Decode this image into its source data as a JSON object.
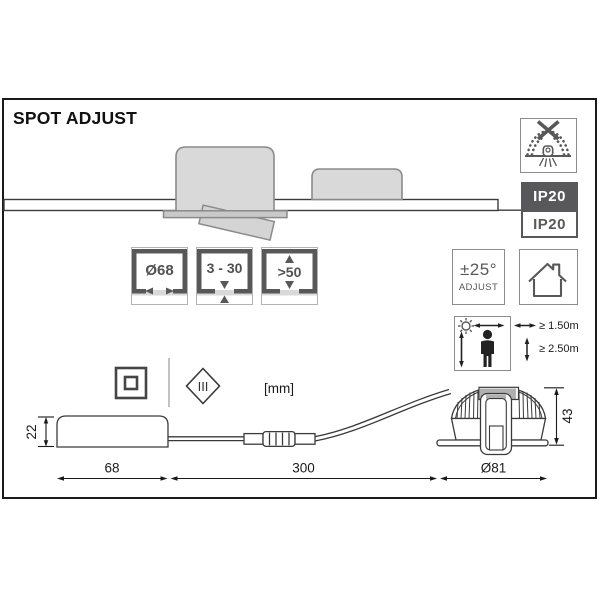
{
  "header": {
    "title": "SPOT ADJUST"
  },
  "ceiling_icons": {
    "cutout_label": "Ø68",
    "thickness_label": "3 - 30",
    "clearance_label": ">50"
  },
  "ratings": {
    "ip_primary": "IP20",
    "ip_secondary": "IP20"
  },
  "adjust": {
    "angle": "±25°",
    "caption": "ADJUST"
  },
  "distances": {
    "horizontal_min": "≥ 1.50m",
    "vertical_min": "≥ 2.50m"
  },
  "units": {
    "note": "[mm]"
  },
  "protection": {
    "class3": "III"
  },
  "dims": {
    "driver_height": "22",
    "driver_length": "68",
    "cable_length": "300",
    "spot_diameter": "Ø81",
    "spot_height": "43"
  },
  "icons": {
    "no_insulation_cover": "no-insulation-cover-icon",
    "indoor_use": "house-icon",
    "min_distance": "person-distance-icon",
    "protection_class_2": "double-square-icon",
    "protection_class_3": "diamond-roman-three-icon"
  },
  "colors": {
    "accent": "#58585a",
    "fill_light": "#d9d9d9",
    "outline": "#8a8a8a",
    "ink": "#1a1a1a"
  }
}
